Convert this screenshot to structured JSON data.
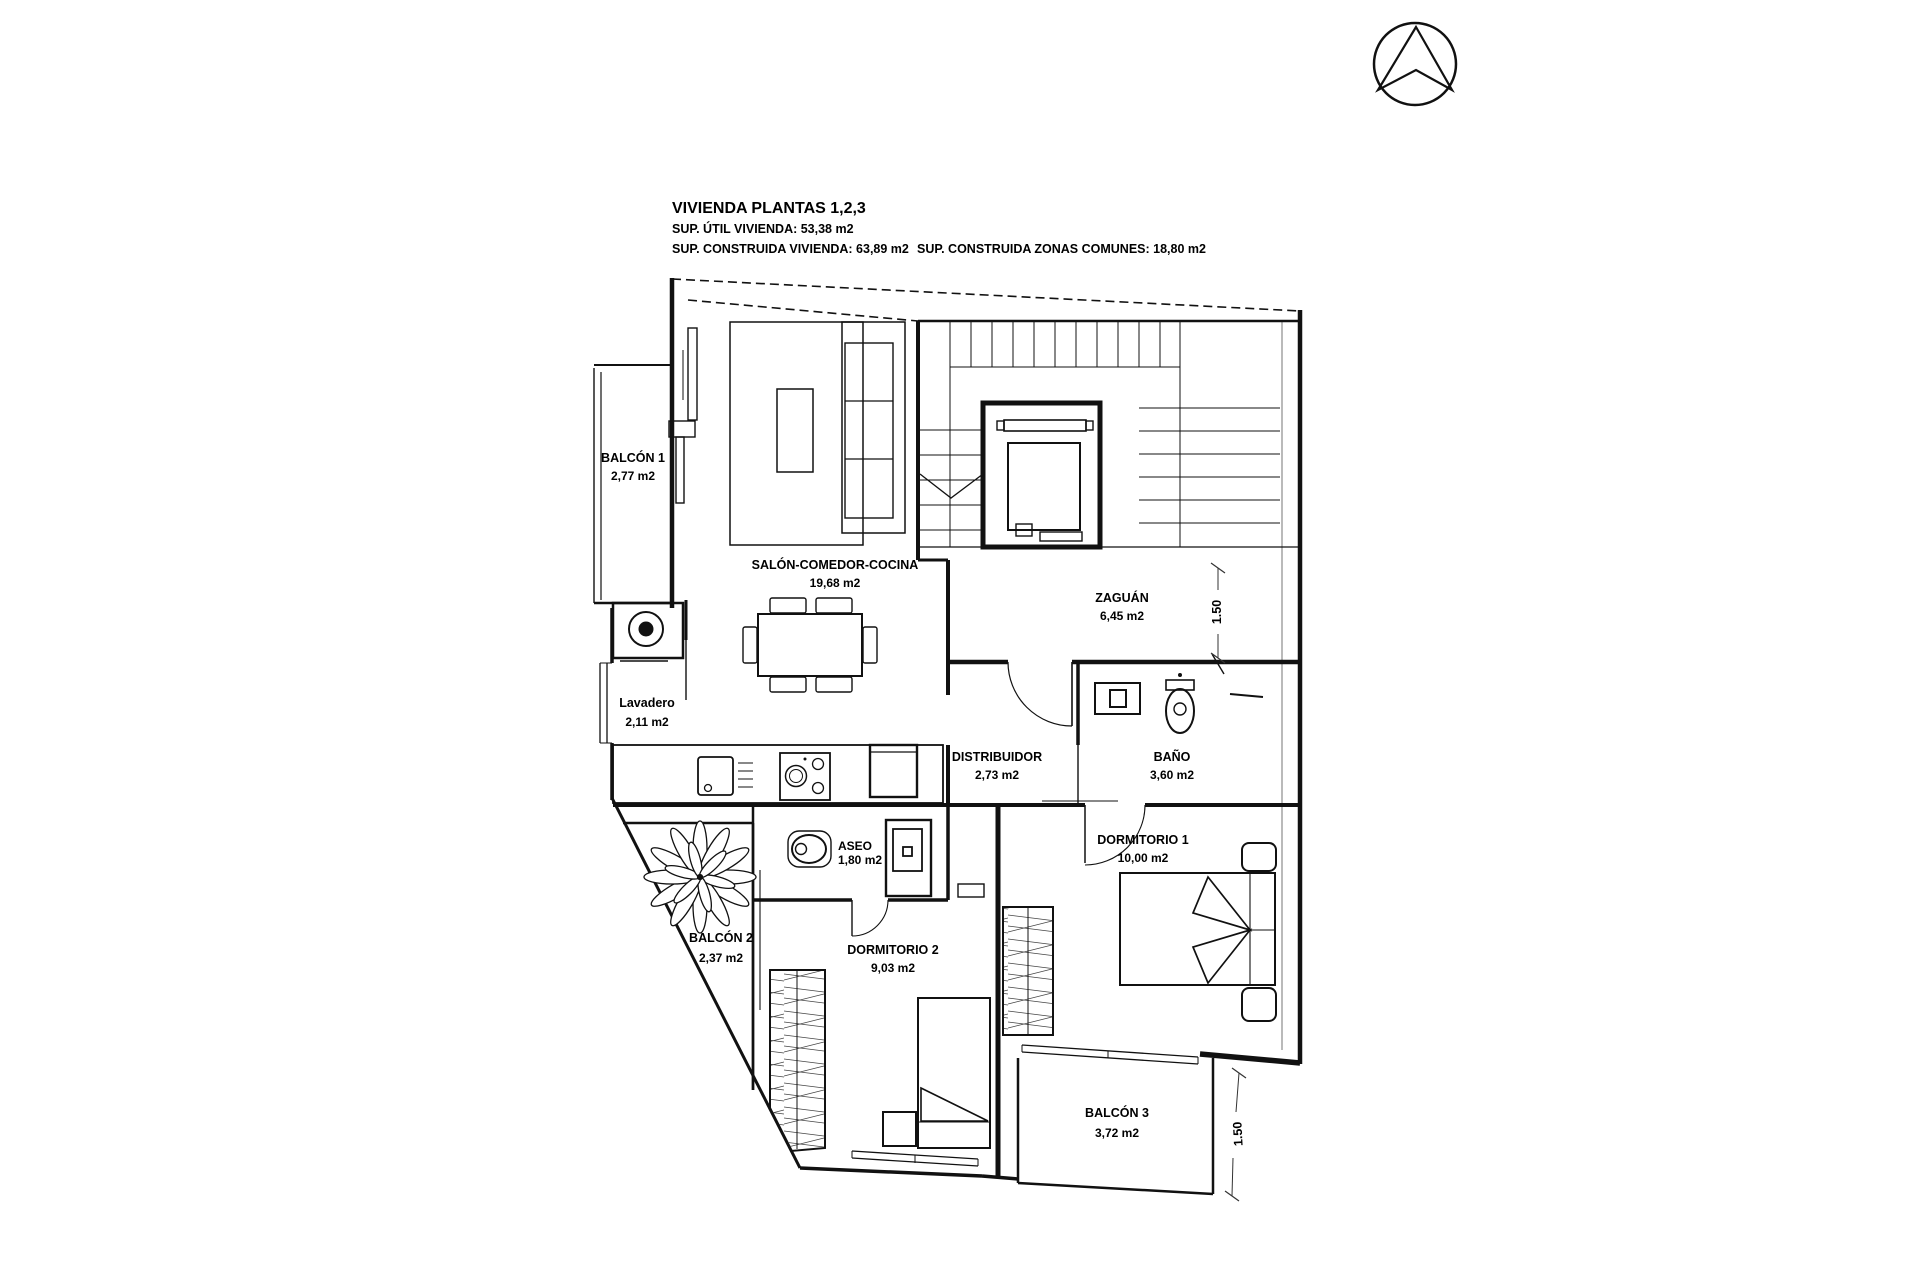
{
  "title_block": {
    "title": "VIVIENDA PLANTAS 1,2,3",
    "line1": "SUP. ÚTIL VIVIENDA: 53,38 m2",
    "line2": "SUP. CONSTRUIDA VIVIENDA: 63,89 m2",
    "line3": "SUP. CONSTRUIDA ZONAS COMUNES: 18,80 m2"
  },
  "rooms": [
    {
      "name": "BALCÓN 1",
      "area": "2,77 m2"
    },
    {
      "name": "SALÓN-COMEDOR-COCINA",
      "area": "19,68 m2"
    },
    {
      "name": "ZAGUÁN",
      "area": "6,45 m2"
    },
    {
      "name": "Lavadero",
      "area": "2,11 m2"
    },
    {
      "name": "DISTRIBUIDOR",
      "area": "2,73 m2"
    },
    {
      "name": "BAÑO",
      "area": "3,60 m2"
    },
    {
      "name": "ASEO",
      "area": "1,80 m2"
    },
    {
      "name": "DORMITORIO 1",
      "area": "10,00 m2"
    },
    {
      "name": "DORMITORIO 2",
      "area": "9,03 m2"
    },
    {
      "name": "BALCÓN 2",
      "area": "2,37 m2"
    },
    {
      "name": "BALCÓN 3",
      "area": "3,72 m2"
    }
  ],
  "dims": [
    {
      "label": "1.50"
    },
    {
      "label": "1.50"
    }
  ],
  "compass": {
    "icon": "north-arrow"
  },
  "colors": {
    "wall": "#111111",
    "text": "#000000",
    "background": "#ffffff"
  }
}
